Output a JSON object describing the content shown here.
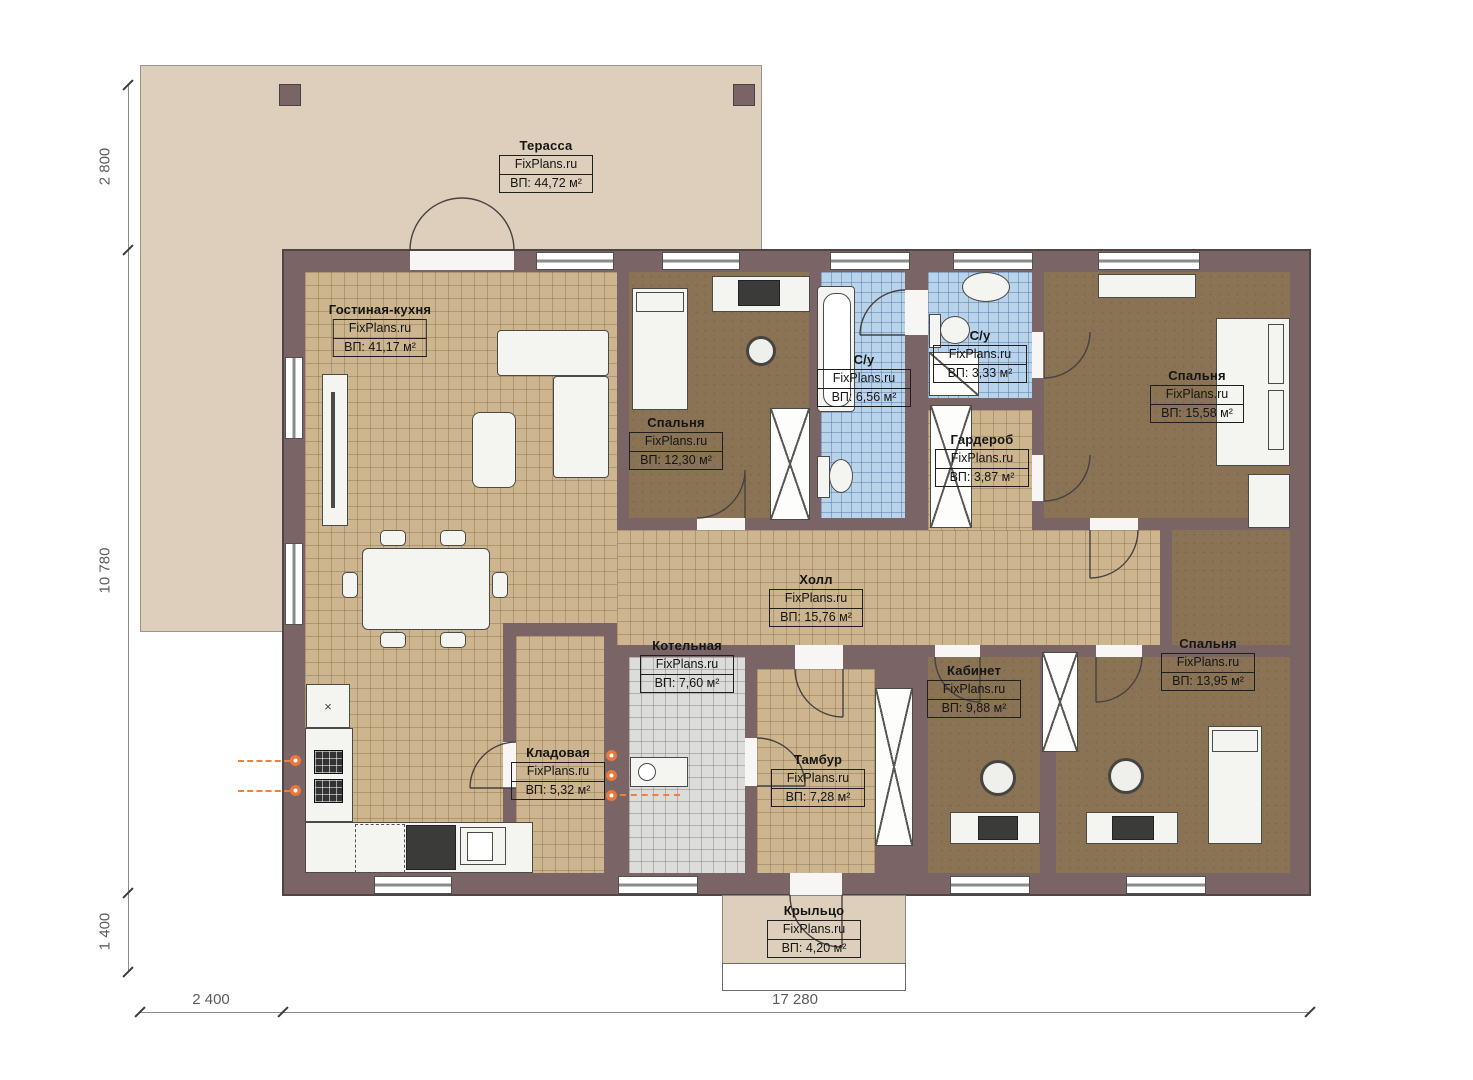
{
  "brand": "FixPlans.ru",
  "rooms": [
    {
      "key": "terrace",
      "name": "Терасса",
      "area": "ВП: 44,72 м²"
    },
    {
      "key": "living-kitchen",
      "name": "Гостиная-кухня",
      "area": "ВП: 41,17 м²"
    },
    {
      "key": "bedroom-1",
      "name": "Спальня",
      "area": "ВП: 12,30 м²"
    },
    {
      "key": "bathroom-1",
      "name": "С/у",
      "area": "ВП: 6,56 м²"
    },
    {
      "key": "bathroom-2",
      "name": "С/у",
      "area": "ВП: 3,33 м²"
    },
    {
      "key": "wardrobe",
      "name": "Гардероб",
      "area": "ВП: 3,87 м²"
    },
    {
      "key": "bedroom-2",
      "name": "Спальня",
      "area": "ВП: 15,58 м²"
    },
    {
      "key": "hall",
      "name": "Холл",
      "area": "ВП: 15,76 м²"
    },
    {
      "key": "boiler-room",
      "name": "Котельная",
      "area": "ВП: 7,60 м²"
    },
    {
      "key": "pantry",
      "name": "Кладовая",
      "area": "ВП: 5,32 м²"
    },
    {
      "key": "vestibule",
      "name": "Тамбур",
      "area": "ВП: 7,28 м²"
    },
    {
      "key": "office",
      "name": "Кабинет",
      "area": "ВП: 9,88 м²"
    },
    {
      "key": "bedroom-3",
      "name": "Спальня",
      "area": "ВП: 13,95 м²"
    },
    {
      "key": "porch",
      "name": "Крыльцо",
      "area": "ВП: 4,20 м²"
    }
  ],
  "dimensions": {
    "terrace_depth": "2 800",
    "house_height": "10 780",
    "porch_depth": "1 400",
    "terrace_offset": "2 400",
    "house_width": "17 280"
  },
  "colors": {
    "wall": "#7b6466",
    "floor_tile_tan": "#cdb68f",
    "floor_brown": "#8a7254",
    "floor_tile_blue": "#b9d3ea",
    "floor_tile_gray": "#dcdcda",
    "terrace": "#ddcfbc",
    "accent_orange": "#e8793a"
  }
}
